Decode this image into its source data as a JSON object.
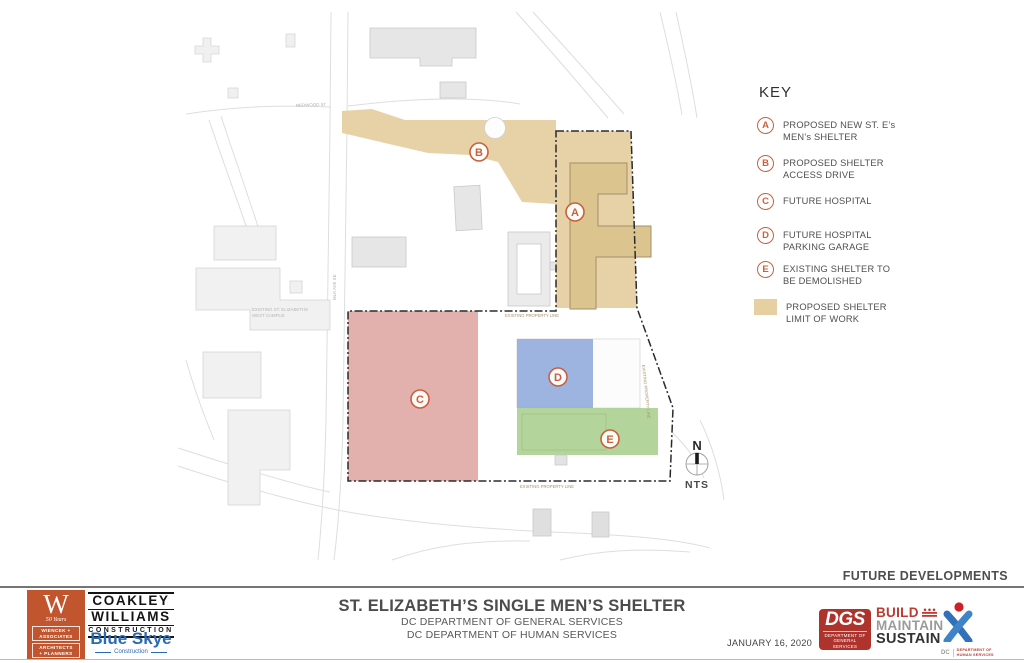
{
  "header": {
    "future_developments": "FUTURE DEVELOPMENTS"
  },
  "key": {
    "title": "KEY",
    "items": [
      {
        "letter": "A",
        "line1": "PROPOSED NEW ST. E’s",
        "line2": "MEN’s SHELTER"
      },
      {
        "letter": "B",
        "line1": "PROPOSED SHELTER",
        "line2": "ACCESS DRIVE"
      },
      {
        "letter": "C",
        "line1": "FUTURE HOSPITAL",
        "line2": ""
      },
      {
        "letter": "D",
        "line1": "FUTURE HOSPITAL",
        "line2": "PARKING GARAGE"
      },
      {
        "letter": "E",
        "line1": "EXISTING SHELTER TO",
        "line2": "BE DEMOLISHED"
      }
    ],
    "swatch_line1": "PROPOSED SHELTER",
    "swatch_line2": "LIMIT OF WORK",
    "swatch_color": "#e6d0a2"
  },
  "map": {
    "markers": {
      "a": "A",
      "b": "B",
      "c": "C",
      "d": "D",
      "e": "E"
    },
    "labels": {
      "redwood": "REDWOOD ST",
      "mlk": "MLK AVE SE",
      "campus1": "EXISTING ST. ELIZABETHS",
      "campus2": "WEST CAMPUS",
      "property_line": "EXISTING PROPERTY LINE"
    },
    "north": {
      "n": "N",
      "nts": "NTS"
    },
    "colors": {
      "limit_of_work": "#e6d0a2",
      "shelter_building": "#dcc48f",
      "future_hospital": "#dfa8a4",
      "parking_garage": "#8fa8dc",
      "existing_shelter": "#a8cf8d",
      "marker": "#c8603c"
    }
  },
  "footer": {
    "title": "ST. ELIZABETH’S SINGLE MEN’S SHELTER",
    "dept1": "DC DEPARTMENT OF GENERAL SERVICES",
    "dept2": "DC DEPARTMENT OF HUMAN SERVICES",
    "date": "JANUARY 16, 2020",
    "wiencek": {
      "w": "W",
      "years": "50 Years",
      "name1": "WIENCEK +",
      "name2": "ASSOCIATES",
      "name3": "ARCHITECTS",
      "name4": "+ PLANNERS"
    },
    "coakley": {
      "line1": "COAKLEY",
      "line2": "WILLIAMS",
      "line3": "CONSTRUCTION"
    },
    "blueskye": {
      "name": "Blue Skye",
      "sub": "Construction"
    },
    "dgs": {
      "abbr": "DGS",
      "sub1": "DEPARTMENT OF",
      "sub2": "GENERAL SERVICES"
    },
    "bms": {
      "build": "BUILD",
      "maintain": "MAINTAIN",
      "sustain": "SUSTAIN"
    },
    "dhs": {
      "dc": "DC",
      "sub1": "DEPARTMENT OF",
      "sub2": "HUMAN SERVICES"
    }
  }
}
